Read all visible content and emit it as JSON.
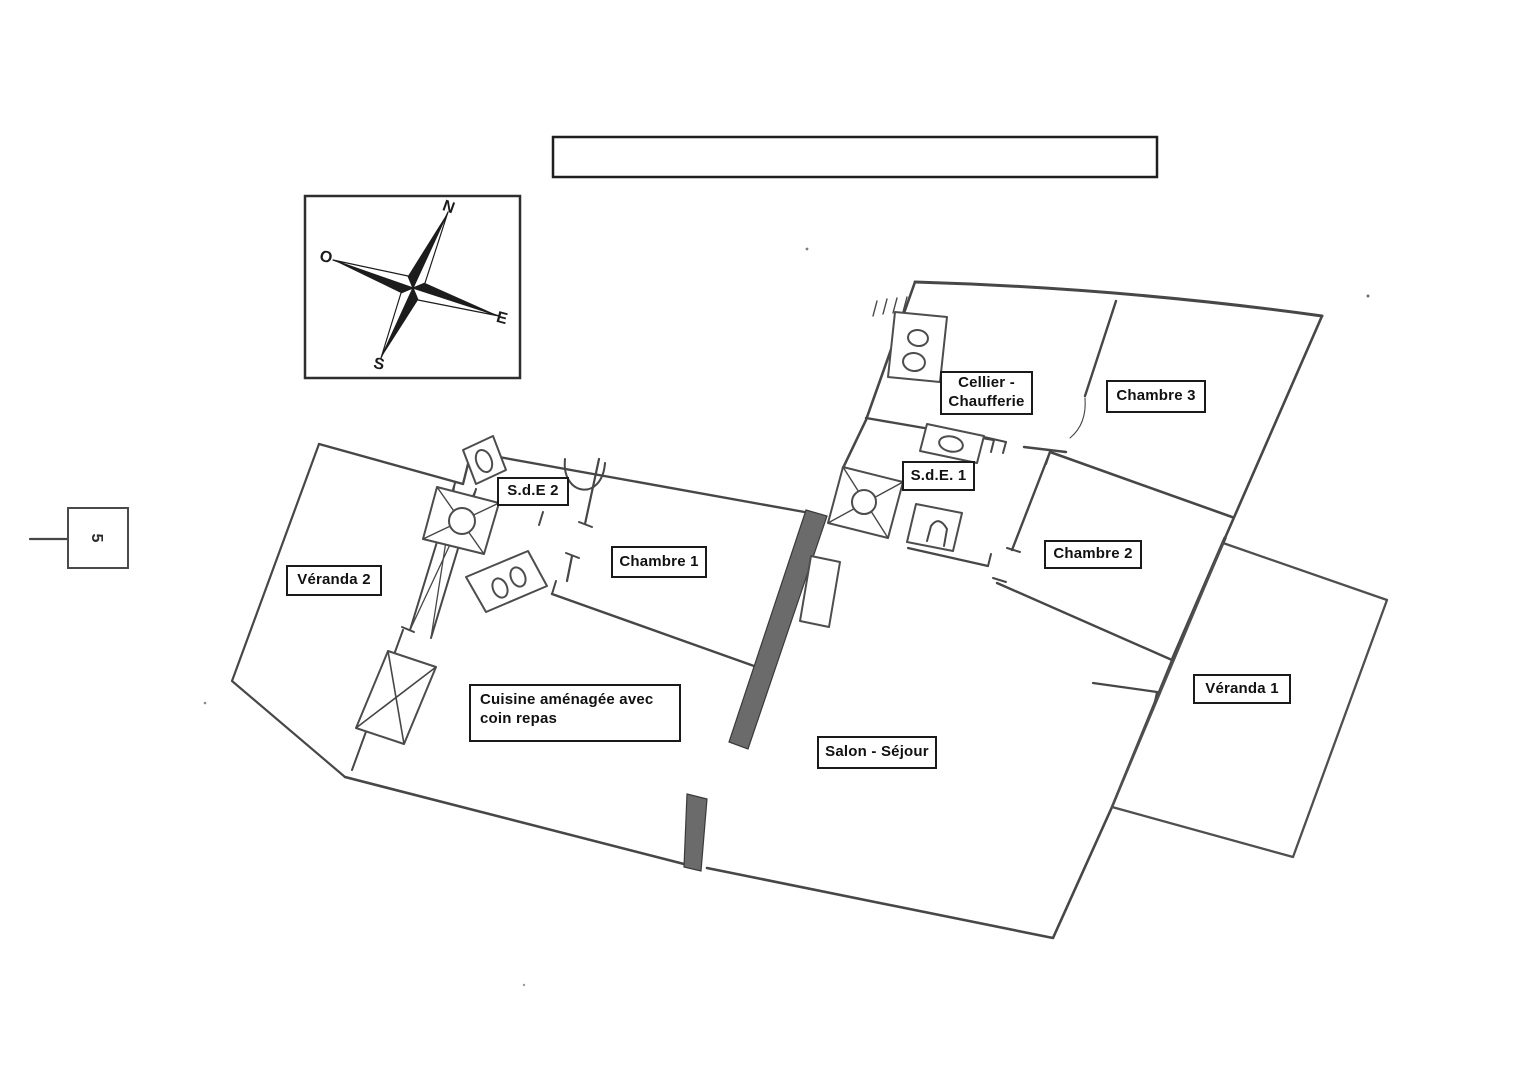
{
  "title_box": {
    "text": ""
  },
  "scale_marker": {
    "label": "5"
  },
  "compass": {
    "north": "N",
    "south": "S",
    "east": "E",
    "west": "O"
  },
  "rooms": [
    {
      "id": "veranda-2",
      "label": "Véranda 2"
    },
    {
      "id": "sde-2",
      "label": "S.d.E 2"
    },
    {
      "id": "chambre-1",
      "label": "Chambre 1"
    },
    {
      "id": "cuisine",
      "label": "Cuisine aménagée avec coin repas"
    },
    {
      "id": "salon-sejour",
      "label": "Salon - Séjour"
    },
    {
      "id": "cellier-chaufferie",
      "label": "Cellier - Chaufferie"
    },
    {
      "id": "sde-1",
      "label": "S.d.E. 1"
    },
    {
      "id": "chambre-2",
      "label": "Chambre 2"
    },
    {
      "id": "chambre-3",
      "label": "Chambre 3"
    },
    {
      "id": "veranda-1",
      "label": "Véranda 1"
    }
  ],
  "colors": {
    "paper": "#ffffff",
    "pencil": "#474747",
    "thick_wall": "#6b6b6b",
    "label_border": "#1a1a1a",
    "compass_dark": "#1c1c1c"
  }
}
